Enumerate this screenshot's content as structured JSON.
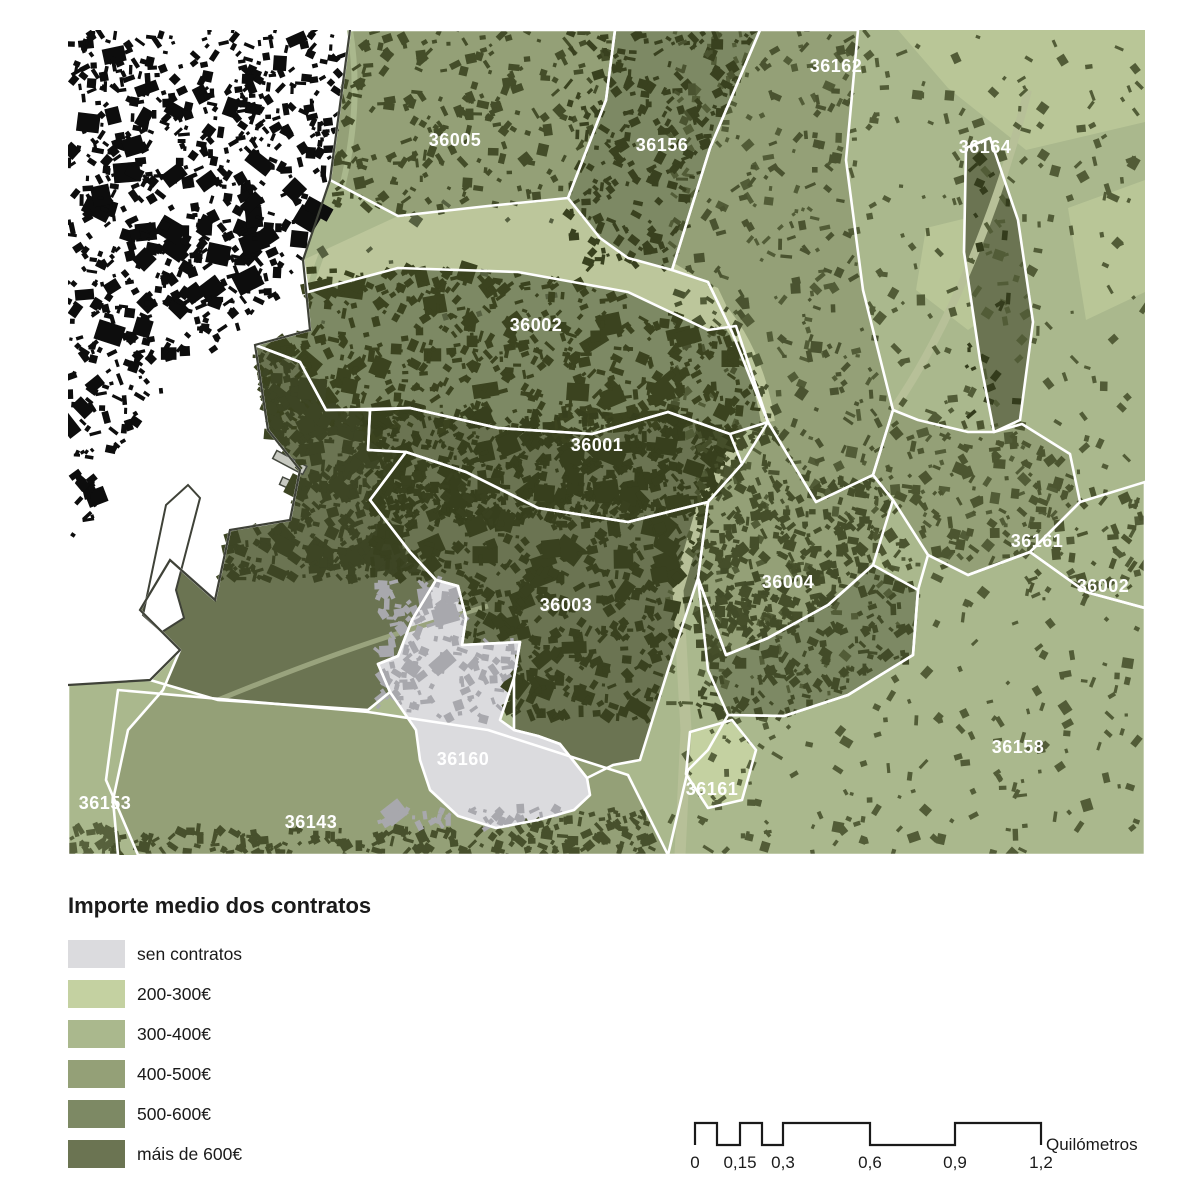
{
  "legend": {
    "title": "Importe medio dos contratos",
    "items": [
      {
        "label": "sen contratos",
        "color": "#dbdbde"
      },
      {
        "label": "200-300€",
        "color": "#c4d1a1"
      },
      {
        "label": "300-400€",
        "color": "#aab88d"
      },
      {
        "label": "400-500€",
        "color": "#94a077"
      },
      {
        "label": "500-600€",
        "color": "#7d8964"
      },
      {
        "label": "máis de 600€",
        "color": "#6b7452"
      }
    ]
  },
  "scalebar": {
    "ticks": [
      "0",
      "0,15",
      "0,3",
      "0,6",
      "0,9",
      "1,2"
    ],
    "unit": "Quilómetros"
  },
  "map": {
    "water_color": "#ffffff",
    "boundary_color": "#ffffff",
    "coast_color": "#3f4238",
    "building_black": "#0d0d0d",
    "building_dark": "#3b431f",
    "building_gray": "#a8a8ad",
    "zones": [
      {
        "id": "36005",
        "category": 3
      },
      {
        "id": "36156",
        "category": 4
      },
      {
        "id": "nordeste-rural",
        "category": 2
      },
      {
        "id": "franxa-leste",
        "category": 3
      },
      {
        "id": "36002-centro",
        "category": 4
      },
      {
        "id": "36001",
        "category": 5
      },
      {
        "id": "suroeste",
        "category": 5
      },
      {
        "id": "36003",
        "category": 5
      },
      {
        "id": "36004",
        "category": 3
      },
      {
        "id": "sueste",
        "category": 4
      },
      {
        "id": "36161-leste",
        "category": 3
      },
      {
        "id": "36002-leste",
        "category": 2
      },
      {
        "id": "36158",
        "category": 2
      },
      {
        "id": "36143",
        "category": 3
      },
      {
        "id": "36153",
        "category": 2
      },
      {
        "id": "serra",
        "category": 5
      },
      {
        "id": "36160",
        "category": 0
      },
      {
        "id": "36161-sur",
        "category": 1
      }
    ],
    "zone_labels": [
      {
        "text": "36162",
        "x": 768,
        "y": 36
      },
      {
        "text": "36005",
        "x": 387,
        "y": 110
      },
      {
        "text": "36156",
        "x": 594,
        "y": 115
      },
      {
        "text": "36164",
        "x": 917,
        "y": 117
      },
      {
        "text": "36002",
        "x": 468,
        "y": 295
      },
      {
        "text": "36001",
        "x": 529,
        "y": 415
      },
      {
        "text": "36161",
        "x": 969,
        "y": 511
      },
      {
        "text": "36002",
        "x": 1035,
        "y": 556
      },
      {
        "text": "36004",
        "x": 720,
        "y": 552
      },
      {
        "text": "36003",
        "x": 498,
        "y": 575
      },
      {
        "text": "36158",
        "x": 950,
        "y": 717
      },
      {
        "text": "36160",
        "x": 395,
        "y": 729
      },
      {
        "text": "36161",
        "x": 644,
        "y": 759
      },
      {
        "text": "36153",
        "x": 37,
        "y": 773
      },
      {
        "text": "36143",
        "x": 243,
        "y": 792
      }
    ]
  }
}
